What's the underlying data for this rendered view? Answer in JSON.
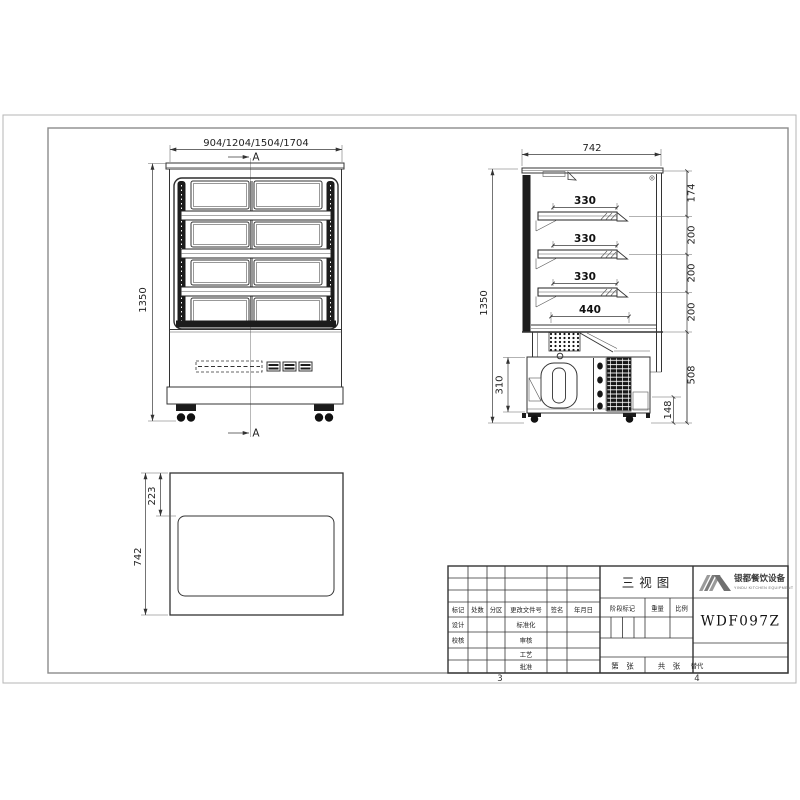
{
  "sheet": {
    "zone_bottom_left": "3",
    "zone_bottom_right": "4"
  },
  "front": {
    "width_dim": "904/1204/1504/1704",
    "height_dim": "1350",
    "section_label": "A"
  },
  "side": {
    "width_dim": "742",
    "height_dim": "1350",
    "shelf_dims": [
      "330",
      "330",
      "330",
      "440"
    ],
    "height_chain": [
      "174",
      "200",
      "200",
      "200",
      "508",
      "148"
    ],
    "machine_dim": "310"
  },
  "top": {
    "depth_dim": "742",
    "inset_dim": "223"
  },
  "title_block": {
    "drawing_title": "三视图",
    "model": "WDF097Z",
    "company_name": "银都餐饮设备",
    "company_name_en": "YINDU KITCHEN EQUIPMENT",
    "rev_headers": [
      "标记",
      "处数",
      "分区",
      "更改文件号",
      "签名",
      "年月日"
    ],
    "role_rows": [
      "设计",
      "校核"
    ],
    "approval_rows": [
      "标准化",
      "审核",
      "工艺",
      "批准"
    ],
    "stage_label": "阶段标记",
    "weight_label": "重量",
    "scale_label": "比例",
    "sheet_label": "第　张",
    "total_label": "共　张",
    "replace_label": "替代"
  }
}
